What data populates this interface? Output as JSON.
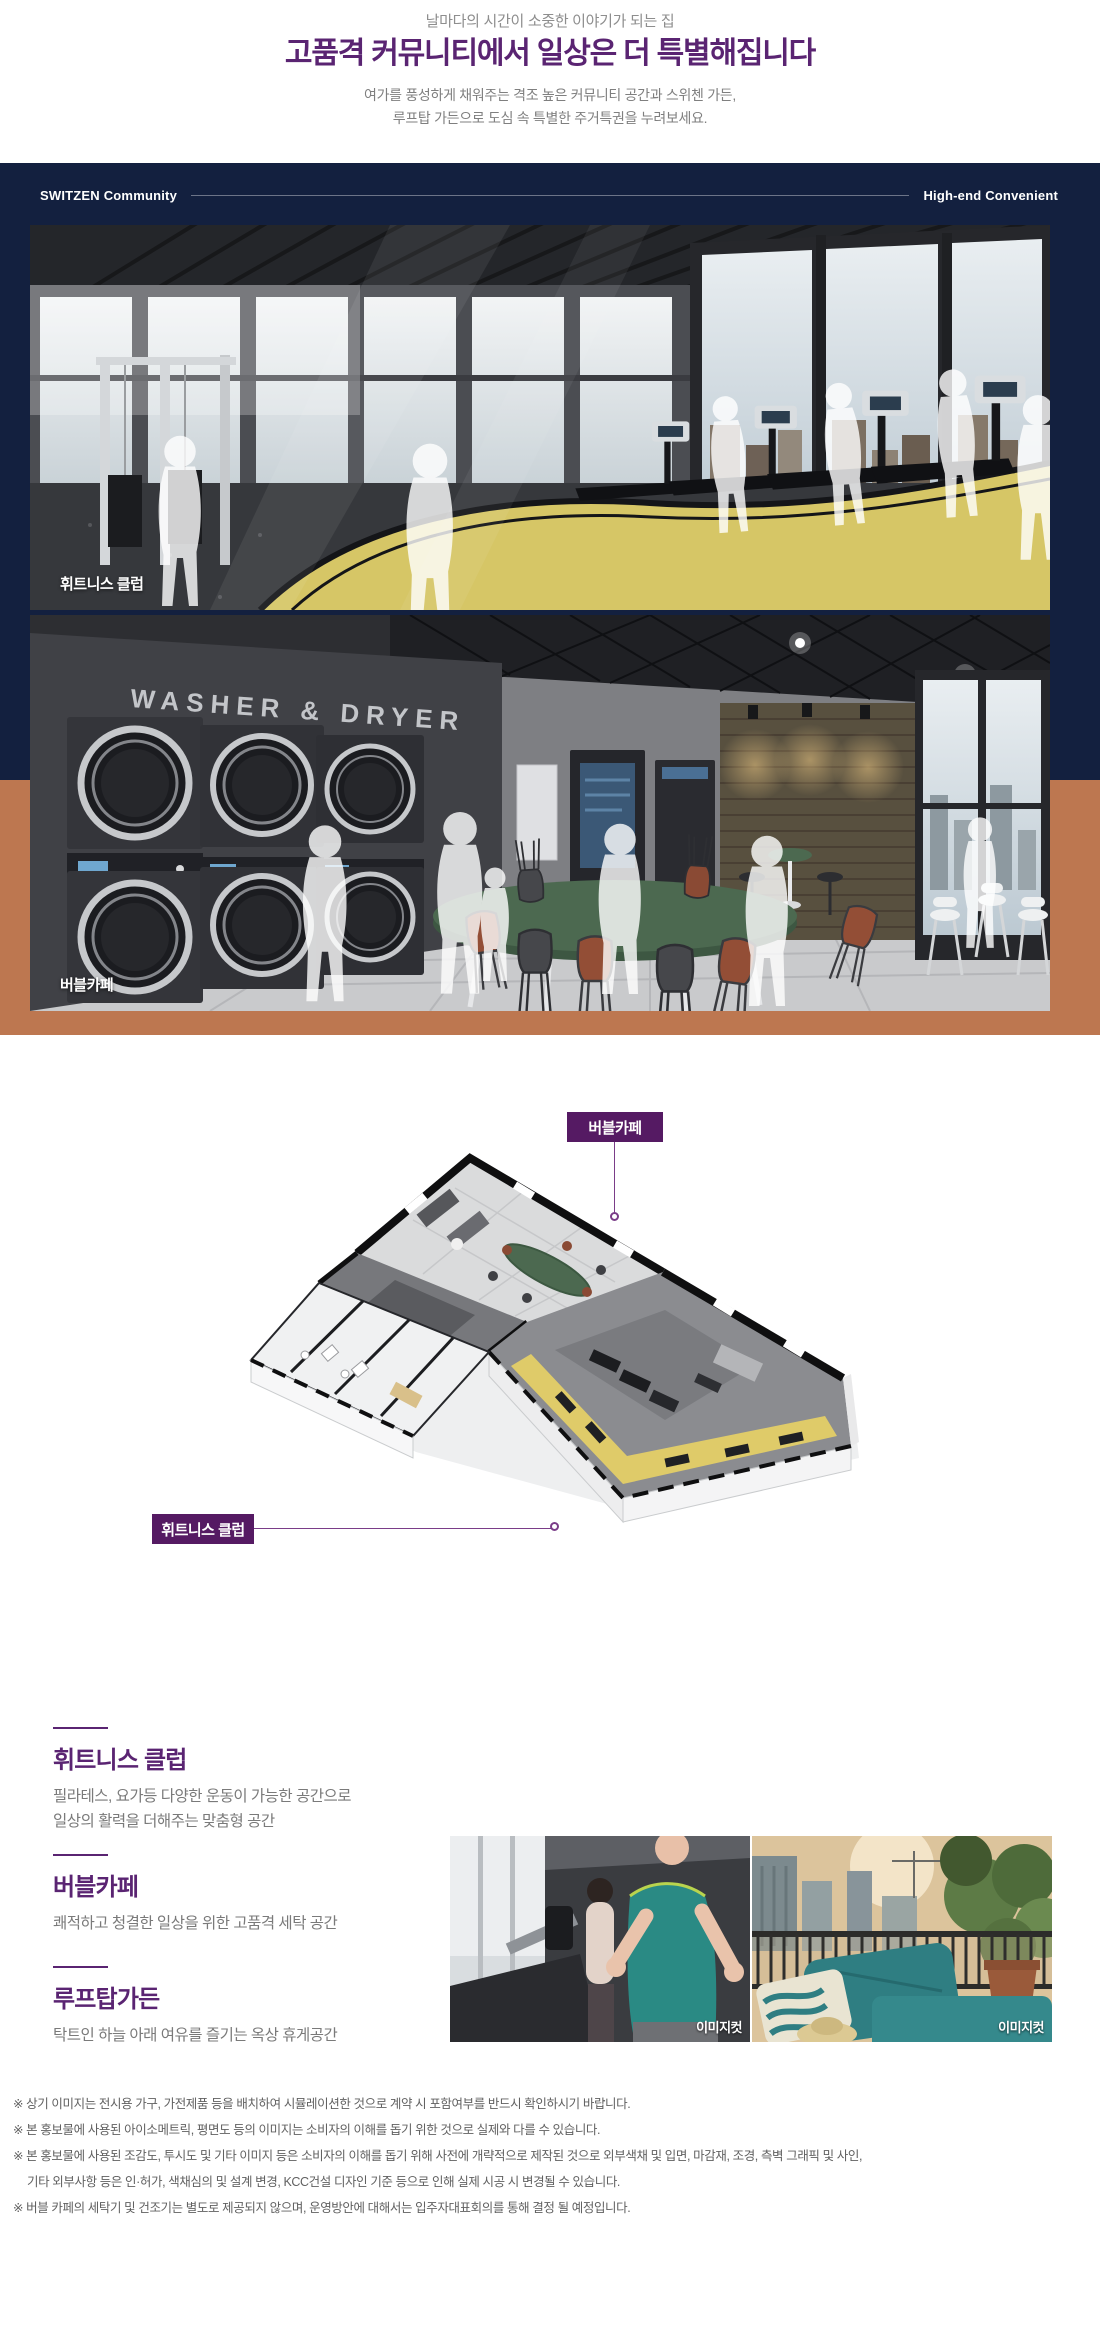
{
  "colors": {
    "navy": "#13203f",
    "terracotta": "#bd7750",
    "purple_title": "#5a2472",
    "purple_tag": "#551a63",
    "leader_purple": "#7a3d88",
    "track_yellow": "#d6c666",
    "table_green": "#4c6950"
  },
  "header": {
    "tagline": "날마다의 시간이 소중한 이야기가 되는 집",
    "title": "고품격 커뮤니티에서 일상은 더 특별해집니다",
    "subtitle1": "여가를 풍성하게 채워주는 격조 높은 커뮤니티 공간과 스위첸 가든,",
    "subtitle2": "루프탑 가든으로 도심 속 특별한 주거특권을 누려보세요."
  },
  "community": {
    "left_label": "SWITZEN Community",
    "right_label": "High-end Convenient",
    "fitness_caption": "휘트니스 클럽",
    "laundry_caption": "버블카페",
    "washer_sign": "WASHER & DRYER"
  },
  "floorplan": {
    "cafe_tag": "버블카페",
    "fitness_tag": "휘트니스 클럽"
  },
  "features": [
    {
      "title": "휘트니스 클럽",
      "line1": "필라테스, 요가등 다양한 운동이 가능한 공간으로",
      "line2": "일상의 활력을 더해주는 맞춤형 공간"
    },
    {
      "title": "버블카페",
      "line1": "쾌적하고 청결한 일상을 위한 고품격 세탁 공간"
    },
    {
      "title": "루프탑가든",
      "line1": "탁트인 하늘 아래 여유를 즐기는 옥상 휴게공간"
    }
  ],
  "photos": [
    {
      "label": "이미지컷"
    },
    {
      "label": "이미지컷"
    }
  ],
  "footnotes": [
    "※ 상기 이미지는 전시용 가구, 가전제품 등을 배치하여 시뮬레이션한 것으로 계약 시 포함여부를 반드시 확인하시기 바랍니다.",
    "※ 본 홍보물에 사용된 아이소메트릭, 평면도 등의 이미지는 소비자의 이해를 돕기 위한 것으로 실제와 다를 수 있습니다.",
    "※ 본 홍보물에 사용된 조감도, 투시도 및 기타 이미지 등은 소비자의 이해를 돕기 위해 사전에 개략적으로 제작된 것으로 외부색채 및 입면, 마감재, 조경, 측벽 그래픽 및 사인,",
    "기타 외부사항 등은 인·허가, 색채심의 및 설계 변경, KCC건설 디자인 기준 등으로 인해 실제 시공 시 변경될 수 있습니다.",
    "※ 버블 카페의 세탁기 및 건조기는 별도로 제공되지 않으며, 운영방안에 대해서는 입주자대표회의를 통해 결정 될 예정입니다."
  ]
}
